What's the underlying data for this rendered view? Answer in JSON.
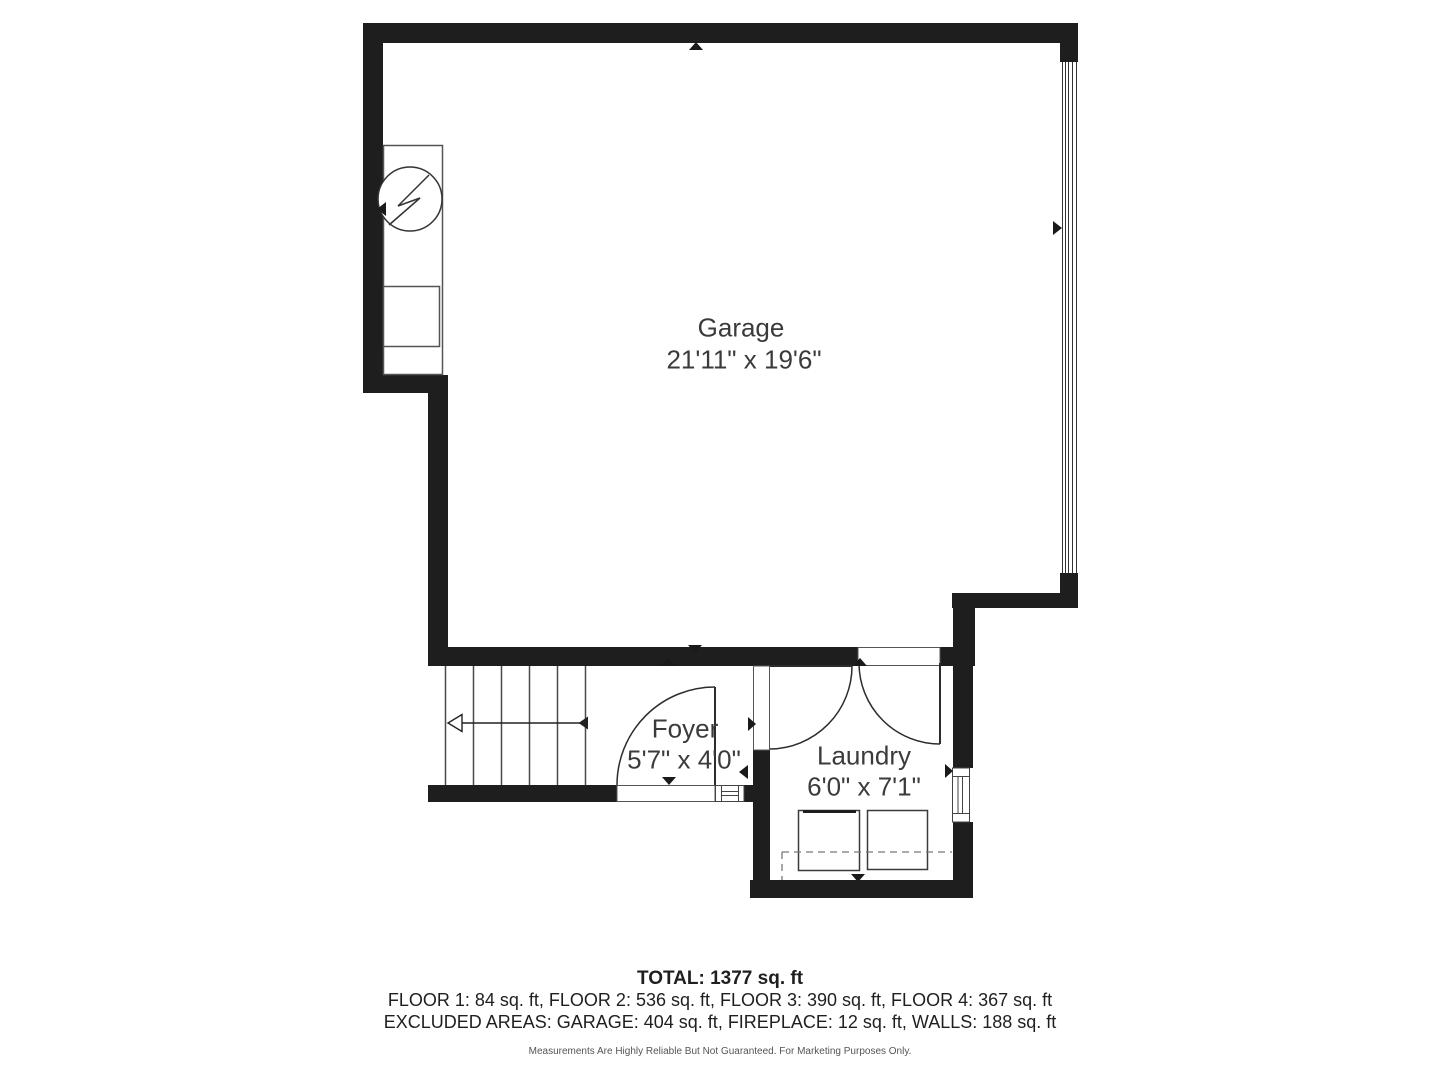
{
  "plan": {
    "title": "Floor plan - garage level",
    "rooms": [
      {
        "name": "Garage",
        "dims": "21'11\" x 19'6\""
      },
      {
        "name": "Foyer",
        "dims": "5'7\" x 4'0\""
      },
      {
        "name": "Laundry",
        "dims": "6'0\" x 7'1\""
      }
    ],
    "fixtures": {
      "water_heater": "circle-with-lightning-bolt",
      "stairs": "six-tread-run-with-direction-arrow",
      "washer": "square-outline-with-control-strip",
      "dryer": "square-outline",
      "garage_door": "multi-line-panel-on-right-wall",
      "windows": "double-pane-symbols",
      "door_markers": "small-solid-triangles"
    },
    "colors": {
      "wall": "#1e1e1e",
      "background": "#ffffff",
      "label": "#3b3b3b",
      "fixture_line": "#4a4a4a",
      "dashed_line": "#777777"
    },
    "footer": {
      "total": "TOTAL: 1377 sq. ft",
      "floors": "FLOOR 1: 84 sq. ft, FLOOR 2: 536 sq. ft, FLOOR 3: 390 sq. ft, FLOOR 4: 367 sq. ft",
      "excluded": "EXCLUDED AREAS: GARAGE: 404 sq. ft, FIREPLACE: 12 sq. ft, WALLS: 188 sq. ft",
      "disclaimer": "Measurements Are Highly Reliable But Not Guaranteed. For Marketing Purposes Only."
    }
  }
}
